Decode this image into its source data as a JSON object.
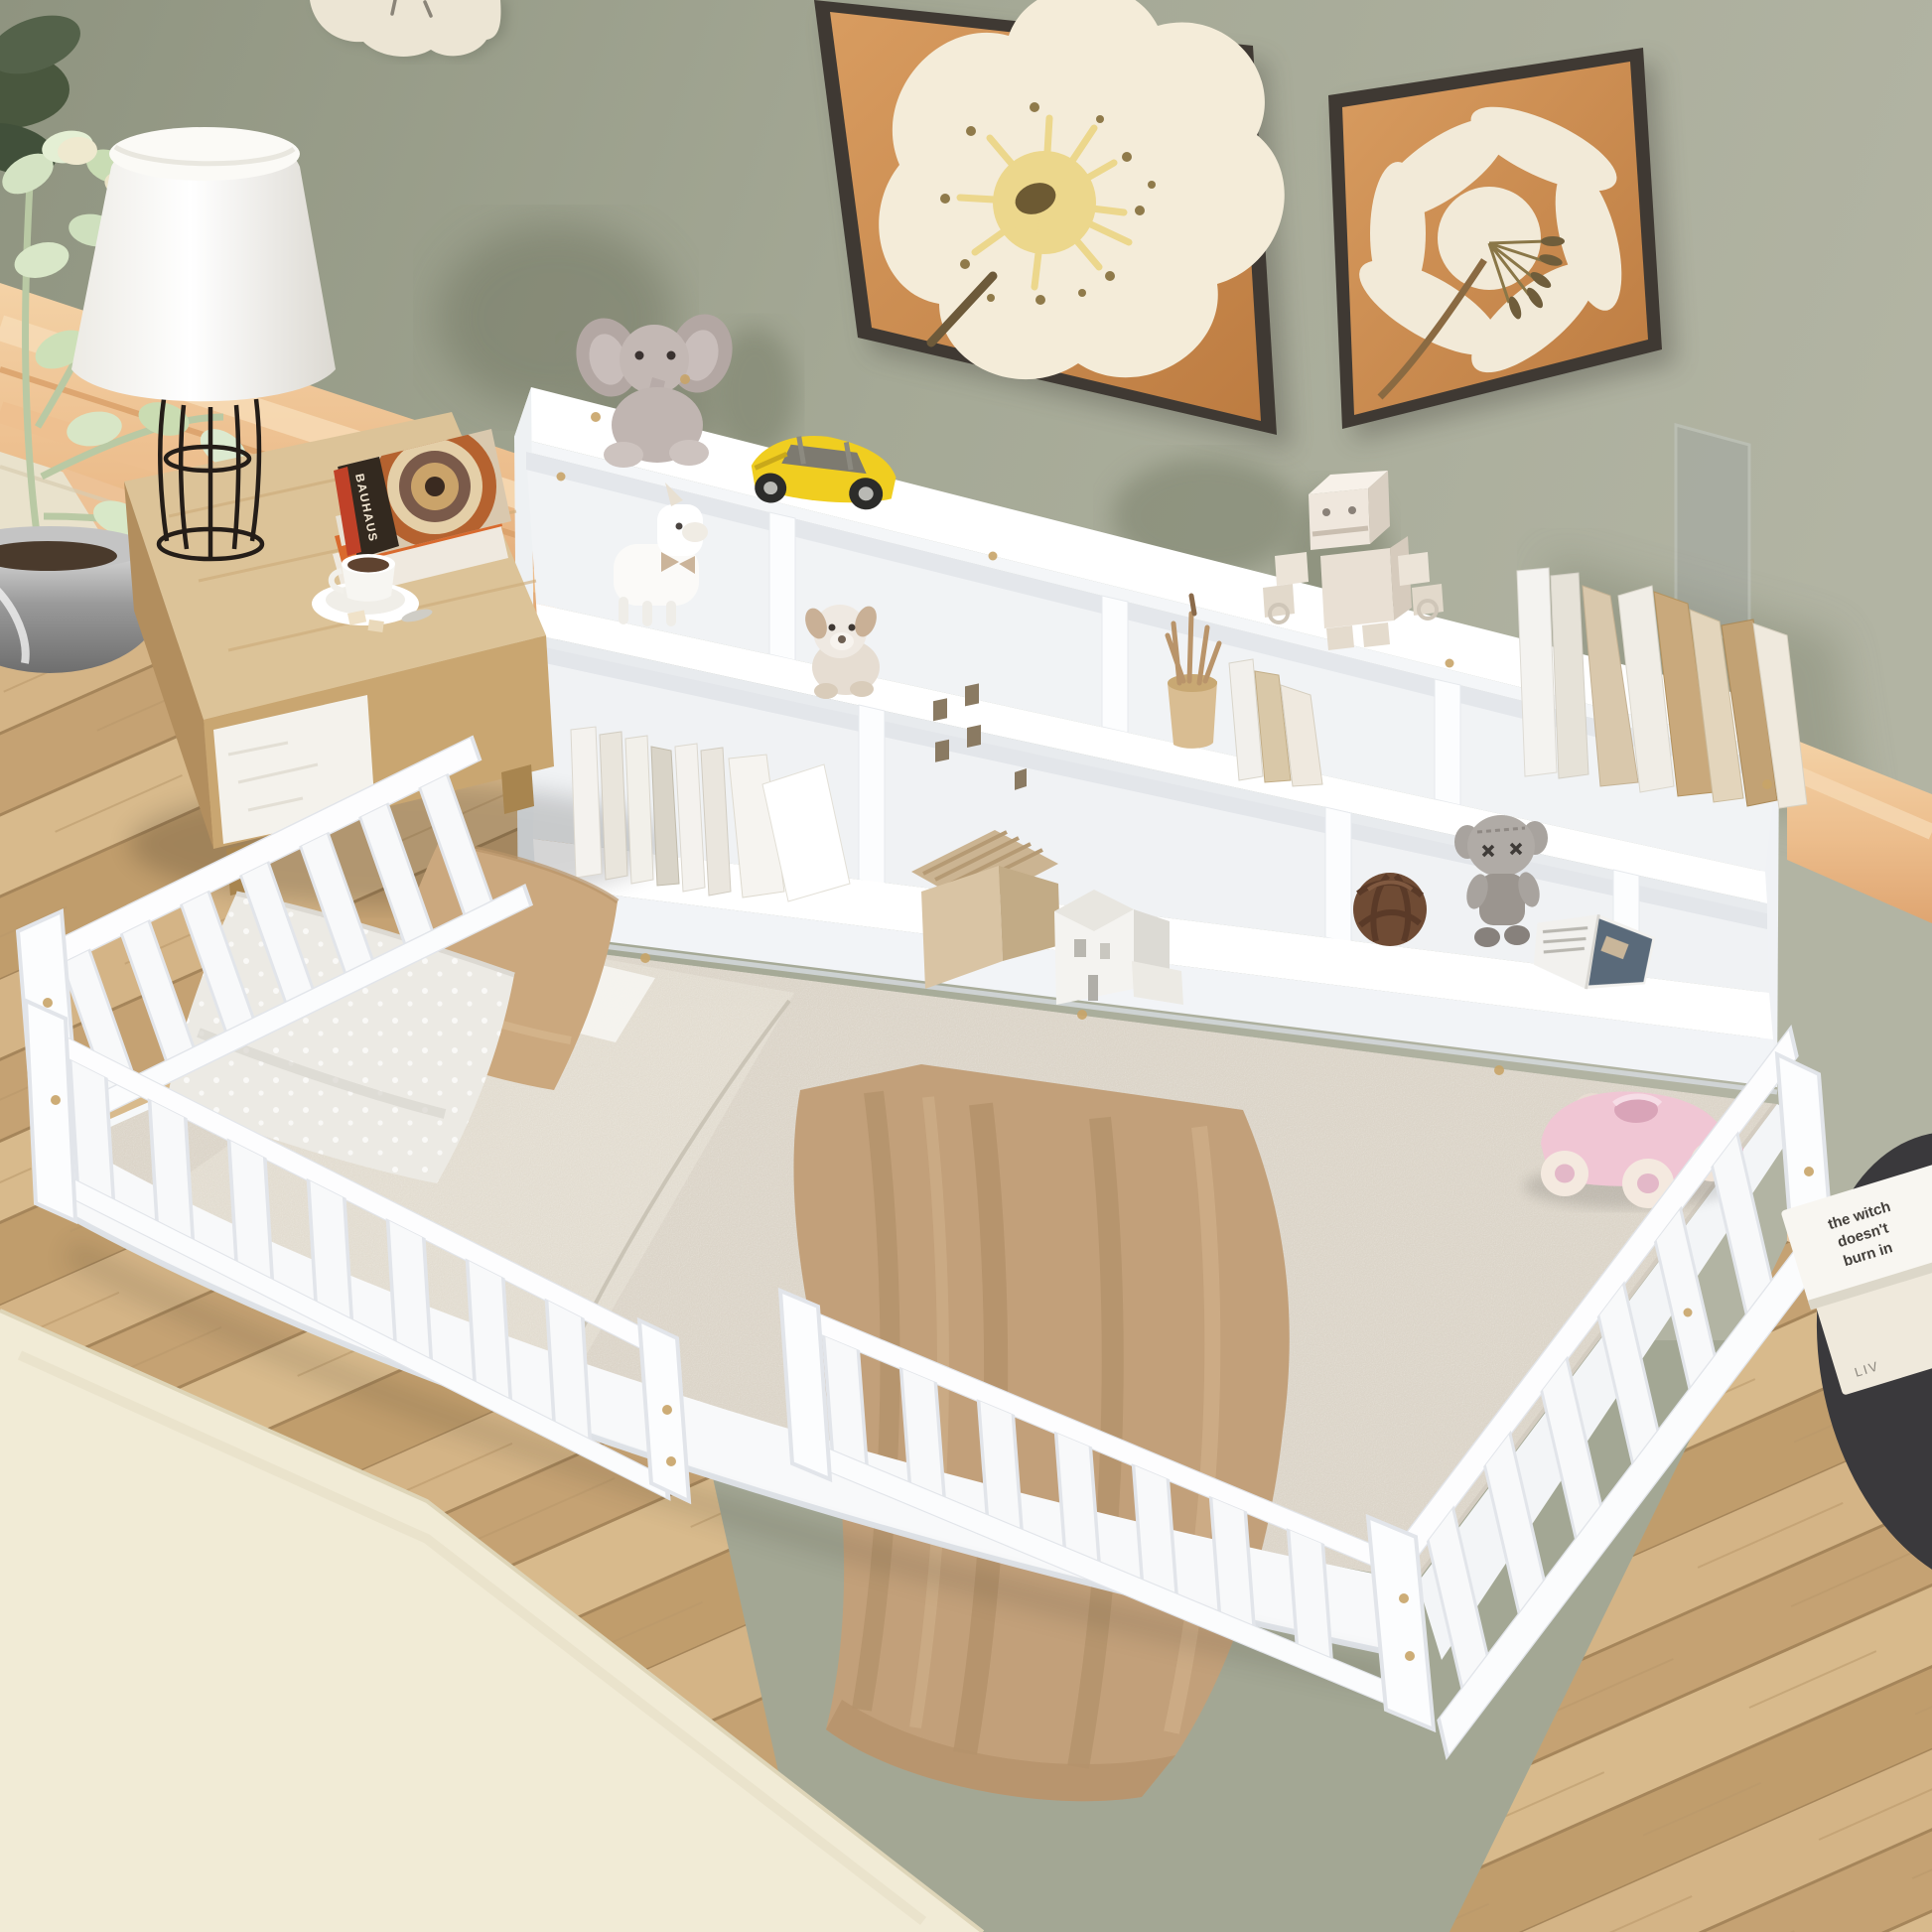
{
  "image": {
    "kind": "furniture product photograph",
    "subject": "White kids twin floor bed with fence guardrails and storage bookcase headboard, styled in a bedroom",
    "camera": "high-angle three-quarter view"
  },
  "palette": {
    "wall_sage": "#a3a794",
    "headboard_peach": "#eaba88",
    "headboard_cream": "#e9e2cc",
    "wood_floor": "#cbaa7c",
    "rug_cream": "#f1ebd6",
    "furniture_white": "#fbfcfd",
    "mattress_boucle": "#dbd4c8",
    "blanket_tan": "#c2a07a",
    "pillow_tan": "#cba87e",
    "toy_yellow": "#f0ce20",
    "toy_pink": "#f0c6d4",
    "art_canvas_orange": "#cf8e54",
    "art_frame_dark": "#3f3933",
    "side_table_dark": "#3a393c",
    "brass_screw": "#c8a468"
  },
  "wall_decor": {
    "clock": "cloud-shaped cream wall clock",
    "paintings": [
      {
        "name": "poppy flower art print",
        "flower": "cream poppy with yellow stamens"
      },
      {
        "name": "lily flower art print",
        "flower": "cream lily with olive anthers"
      }
    ]
  },
  "left_side": {
    "plant": "pale jade plant in chrome pot",
    "lamp": "white empire-shade lamp with black wire cage base",
    "nightstand": "light oak nightstand with white crackle drawer",
    "nightstand_items": [
      "stack of art books",
      "coffee cup on saucer",
      "sugar cubes"
    ]
  },
  "bookcase": {
    "description": "white 2-tier bookcase headboard with open cubbies and display top",
    "top_items": [
      "gray elephant plush",
      "yellow toy sports car",
      "cream block robot",
      "row of leaning books",
      "acrylic frame"
    ],
    "upper_cubby_items": [
      "white unicorn plush",
      "beige puppy plush"
    ],
    "lower_cubby_items": [
      "row of white books",
      "wooden pencil cup",
      "leaning booklets",
      "brown knot ball",
      "gray cartoon figure"
    ],
    "ledge_items": [
      "tan model house",
      "white model house",
      "open magazine",
      "pink toy race car"
    ]
  },
  "bed": {
    "mattress": "beige boucle twin mattress on floor",
    "blanket": "tan throw blanket with long folds",
    "pillows": [
      "white polka-dot pillow",
      "tan pillow"
    ],
    "rails": [
      "head guardrail",
      "front-left guardrail",
      "foot guardrail",
      "foot-side guardrail"
    ]
  },
  "right_side": {
    "table": "dark round side table",
    "books": [
      "the witch doesn't burn in …",
      "LIV"
    ]
  },
  "texts": {
    "bauhaus_spine": "BAUHAUS",
    "bauhaus_spine2": "BAUHAUS",
    "witch_line1": "the witch",
    "witch_line2": "doesn't",
    "witch_line3": "burn in",
    "liv_spine": "LIV"
  }
}
